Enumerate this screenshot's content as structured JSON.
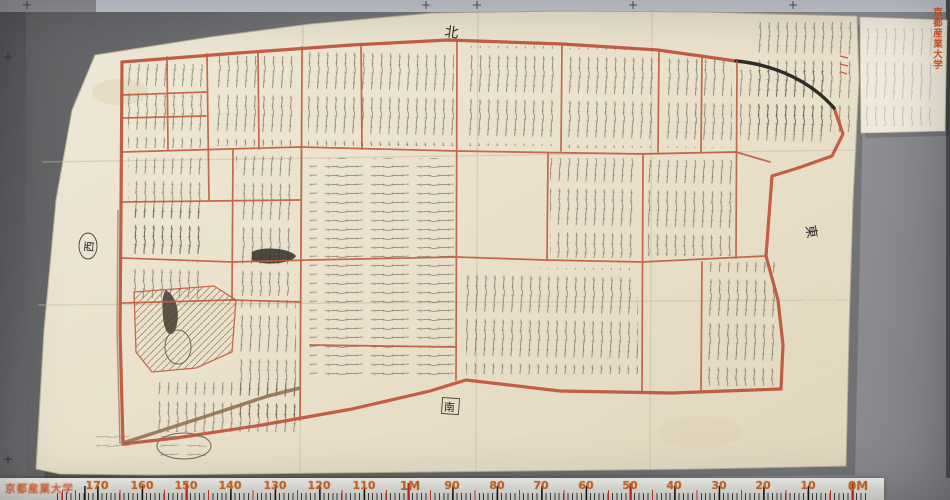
{
  "scan": {
    "institution_stamp": "京都産業大学",
    "compass": {
      "north": "北",
      "south": "南",
      "east": "東",
      "west": "西"
    },
    "ruler": {
      "labels": [
        "170",
        "160",
        "150",
        "140",
        "130",
        "120",
        "110",
        "1M",
        "90",
        "80",
        "70",
        "60",
        "50",
        "40",
        "30",
        "20",
        "10",
        "0M"
      ]
    },
    "colors": {
      "boundary_red": "#c0513a",
      "ruler_number_orange": "#cf6a26",
      "stamp_red": "#dd5420",
      "paper": "#e9e1cd",
      "background_gray": "#737477",
      "top_band": "#c5c8d1"
    }
  }
}
